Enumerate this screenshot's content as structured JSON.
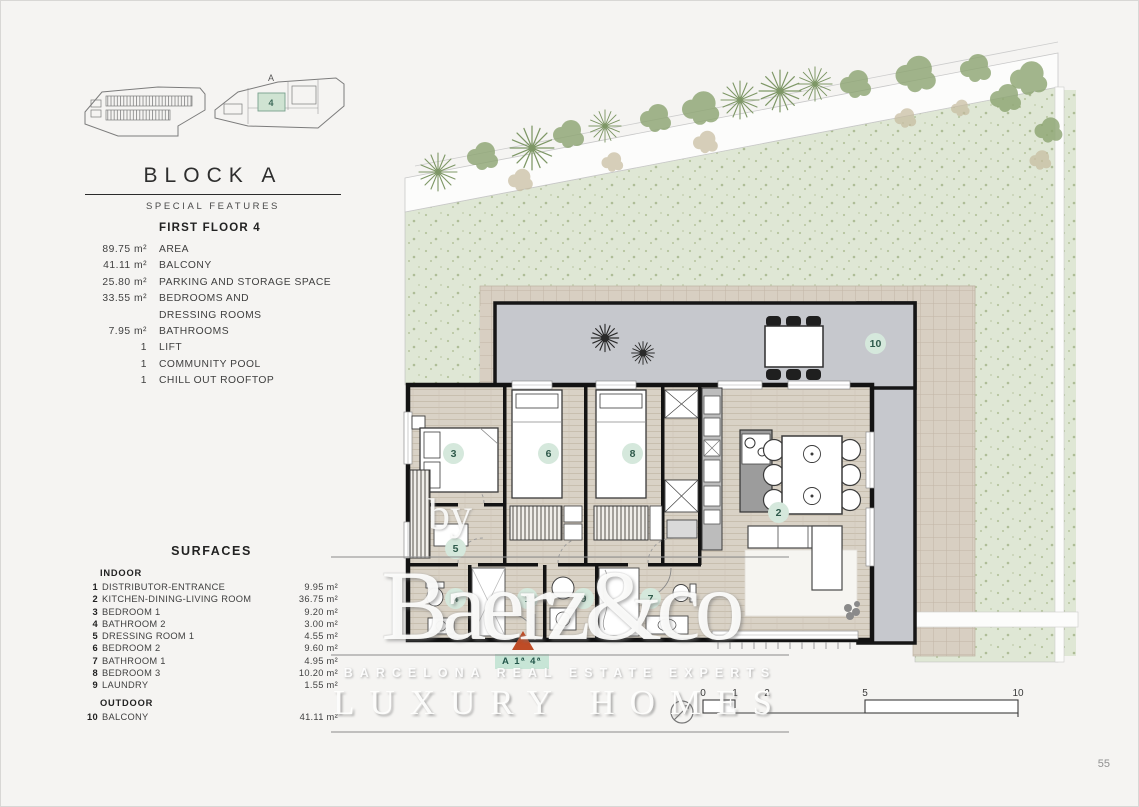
{
  "site_overview": {
    "block_label": "A",
    "unit_number": "4"
  },
  "title_block": {
    "title": "BLOCK A",
    "subtitle": "SPECIAL FEATURES"
  },
  "features": {
    "heading": "FIRST FLOOR 4",
    "items": [
      {
        "value": "89.75 m²",
        "label": "AREA"
      },
      {
        "value": "41.11 m²",
        "label": "BALCONY"
      },
      {
        "value": "25.80 m²",
        "label": "PARKING AND STORAGE SPACE"
      },
      {
        "value": "33.55 m²",
        "label": "BEDROOMS AND DRESSING ROOMS"
      },
      {
        "value": "7.95 m²",
        "label": "BATHROOMS"
      },
      {
        "value": "1",
        "label": "LIFT"
      },
      {
        "value": "1",
        "label": "COMMUNITY POOL"
      },
      {
        "value": "1",
        "label": "CHILL OUT ROOFTOP"
      }
    ]
  },
  "surfaces": {
    "heading": "SURFACES",
    "indoor_heading": "INDOOR",
    "outdoor_heading": "OUTDOOR",
    "indoor": [
      {
        "n": "1",
        "label": "DISTRIBUTOR-ENTRANCE",
        "value": "9.95 m²"
      },
      {
        "n": "2",
        "label": "KITCHEN-DINING-LIVING ROOM",
        "value": "36.75 m²"
      },
      {
        "n": "3",
        "label": "BEDROOM 1",
        "value": "9.20 m²"
      },
      {
        "n": "4",
        "label": "BATHROOM 2",
        "value": "3.00 m²"
      },
      {
        "n": "5",
        "label": "DRESSING ROOM 1",
        "value": "4.55 m²"
      },
      {
        "n": "6",
        "label": "BEDROOM 2",
        "value": "9.60 m²"
      },
      {
        "n": "7",
        "label": "BATHROOM 1",
        "value": "4.95 m²"
      },
      {
        "n": "8",
        "label": "BEDROOM 3",
        "value": "10.20 m²"
      },
      {
        "n": "9",
        "label": "LAUNDRY",
        "value": "1.55 m²"
      }
    ],
    "outdoor": [
      {
        "n": "10",
        "label": "BALCONY",
        "value": "41.11 m²"
      }
    ]
  },
  "floor_plan": {
    "markers": {
      "bedroom1": "3",
      "bedroom2": "6",
      "bedroom3": "8",
      "dressing": "5",
      "living": "2",
      "bath2": "4",
      "entrance": "1",
      "laundry": "9",
      "bath1": "7",
      "balcony": "10"
    },
    "entrance_tag": "A 1ª 4ª",
    "scale_labels": [
      "0",
      "1",
      "2",
      "5",
      "10"
    ]
  },
  "watermark": {
    "by": "by",
    "brand": "Baerz&co",
    "tagline": "BARCELONA REAL ESTATE EXPERTS",
    "subtitle": "LUXURY HOMES"
  },
  "page_number": "55",
  "colors": {
    "marker_bg": "#d5e8dc",
    "marker_text": "#2f5a4b",
    "entrance_arrow": "#bf4c26",
    "unit_highlight": "#cfe3d2",
    "garden": "#dfe7d5",
    "terrace_tile": "#d8cfc2",
    "balcony_gray": "#c6c8cd"
  }
}
